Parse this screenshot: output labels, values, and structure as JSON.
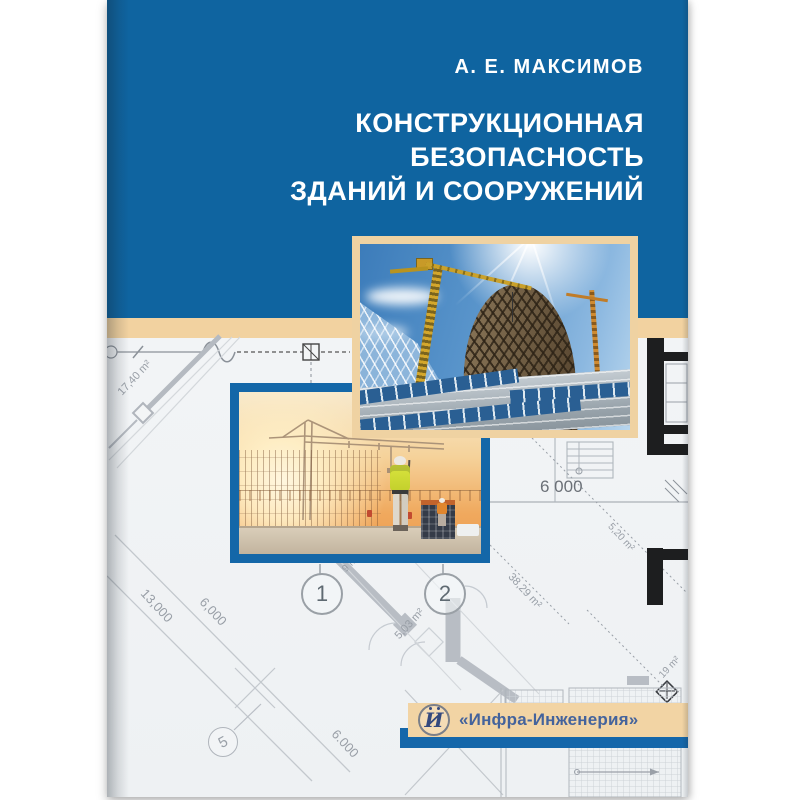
{
  "book_cover": {
    "author": "А. Е. МАКСИМОВ",
    "title_line1": "КОНСТРУКЦИОННАЯ",
    "title_line2": "БЕЗОПАСНОСТЬ",
    "title_line3": "ЗДАНИЙ И СООРУЖЕНИЙ",
    "publisher": {
      "logo_letter": "И",
      "name": "«Инфра-Инженерия»"
    },
    "blueprint": {
      "axis_markers": {
        "m1": "1",
        "m2": "2",
        "m5": "5"
      },
      "dimensions": {
        "horizontal_6000": "6 000",
        "diag_17_40": "17,40 m²",
        "diag_13000": "13,000",
        "diag_6000_left": "6,000",
        "diag_6000_bottom": "6.000"
      },
      "areas": {
        "a9": "9 m²",
        "a5_03": "5,03 m²",
        "a38_29": "38,29 m²",
        "a5_20": "5,20 m²",
        "a19": "19 m²"
      }
    },
    "colors": {
      "cover_blue": "#0f64a0",
      "band_beige": "#f2d2a0",
      "photo_frame_blue": "#1467a8",
      "publisher_band_blue": "#1567aa",
      "publisher_text_blue": "#44639c"
    }
  }
}
